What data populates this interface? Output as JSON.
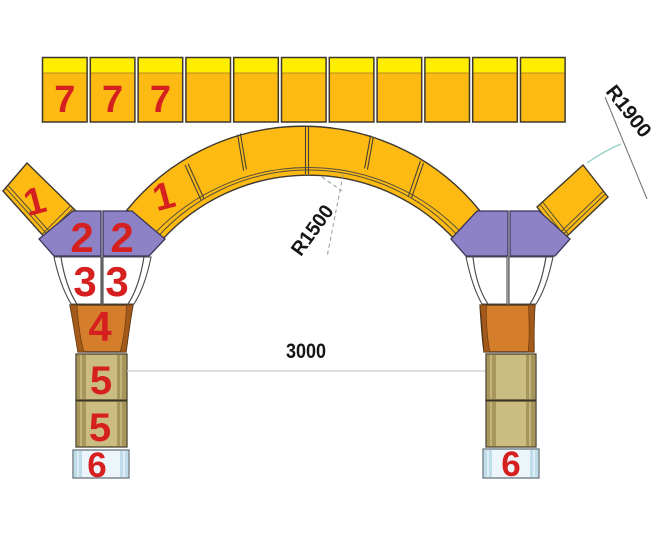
{
  "top_row": {
    "labels": [
      "7",
      "7",
      "7",
      "",
      "",
      "",
      "",
      "",
      "",
      "",
      ""
    ]
  },
  "arch": {
    "segment_label": "1"
  },
  "detached_left": {
    "label": "1"
  },
  "left_column": {
    "purple_labels": [
      "2",
      "2"
    ],
    "white_labels": [
      "3",
      "3"
    ],
    "orange_label": "4",
    "tan_labels": [
      "5",
      "5"
    ],
    "base_label": "6"
  },
  "right_column": {
    "base_label": "6"
  },
  "dimensions": {
    "span": "3000",
    "inner_radius": "R1500",
    "outer_radius": "R1900"
  },
  "colors": {
    "strip-yellow": "#ffee00",
    "gold": "#fcba12",
    "gold-edge": "#b9891b",
    "outline": "#3d3830",
    "purple": "#8d82c6",
    "purple-outline": "#3a3458",
    "orange": "#d47d2a",
    "orange-dark": "#a2591a",
    "tan": "#cbbc82",
    "tan-dark": "#a7955a",
    "pale-blue": "#ecf5f9",
    "blue-band": "#bedce9",
    "label-red": "#d62020",
    "dim-gray": "#c9c9c9",
    "leader-teal": "#8fd2c6",
    "dash-gray": "#9a9a9a",
    "line-dark": "#6e6e6e"
  }
}
